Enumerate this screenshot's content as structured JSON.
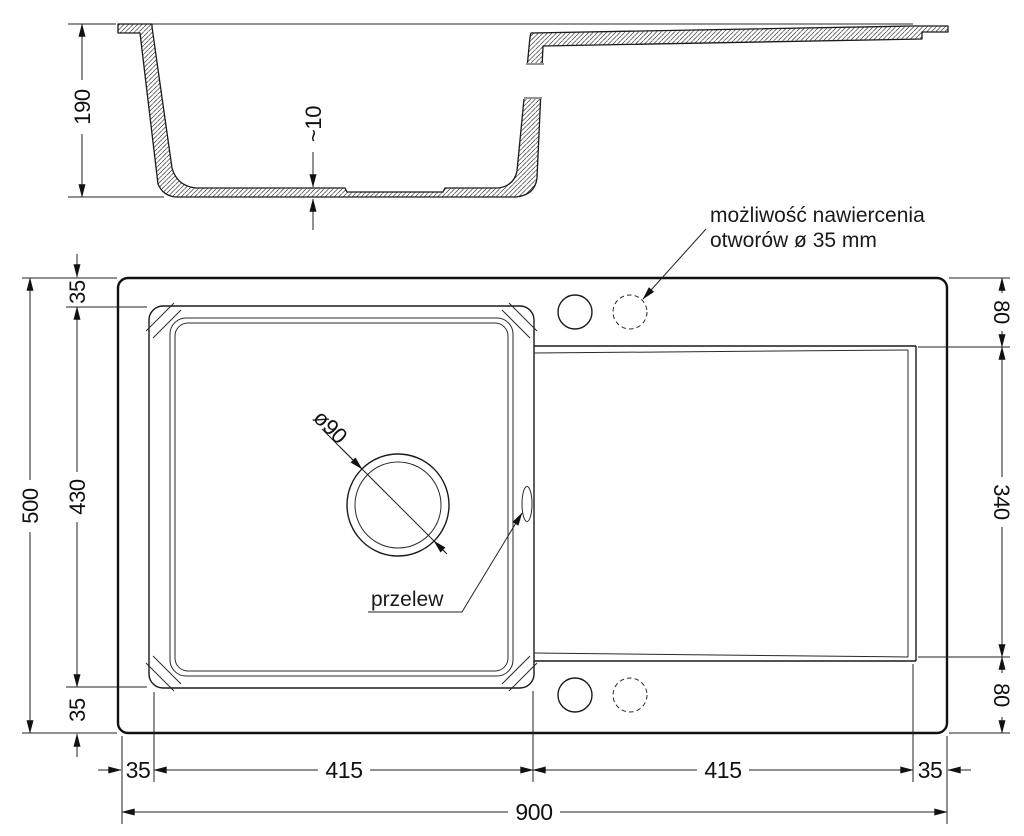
{
  "side_view": {
    "depth": "190",
    "base_thickness": "~10"
  },
  "plan_view": {
    "overall_height": "500",
    "left_segments": [
      "35",
      "430",
      "35"
    ],
    "right_segments": [
      "80",
      "340",
      "80"
    ],
    "bottom_segments": [
      "35",
      "415",
      "415",
      "35"
    ],
    "overall_width": "900",
    "drain_diameter": "ø90",
    "overflow_label": "przelew",
    "drill_note": {
      "line1": "możliwość nawiercenia",
      "line2": "otworów ø 35 mm"
    }
  },
  "colors": {
    "line": "#1a1a1a",
    "background": "#ffffff"
  }
}
